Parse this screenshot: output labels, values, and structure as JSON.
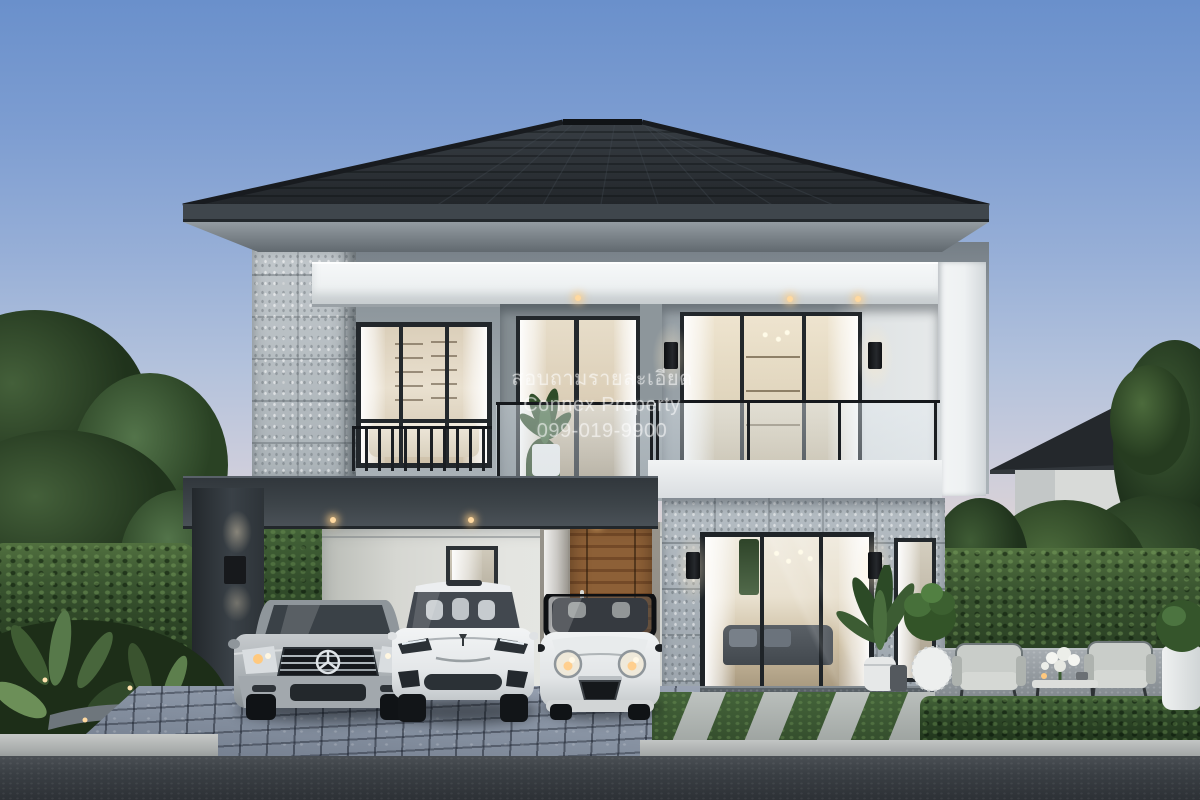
{
  "watermark": {
    "line1": "สอบถามรายละเอียด",
    "line2": "Connex Property",
    "line3": "099-019-9900"
  },
  "scene": {
    "type": "architectural-exterior-render-dusk",
    "colors": {
      "sky_top": "#6a90cb",
      "sky_horizon": "#eedcd1",
      "roof_tile": "#2d3237",
      "fascia": "#3f464c",
      "wall_upper_gray": "#9aa3a8",
      "trim_white": "#f2f4f5",
      "stone_cladding": "#b8bfc3",
      "carport_dark": "#3e454a",
      "door_wood": "#8a5e37",
      "window_glow": "#dccfb8",
      "foliage_dark": "#263a24",
      "hedge_green": "#3a5530",
      "cobble_pavers": "#8d97a7",
      "asphalt": "#3c4145",
      "grass": "#3f5e33",
      "warm_light": "#ffd9a0"
    }
  }
}
